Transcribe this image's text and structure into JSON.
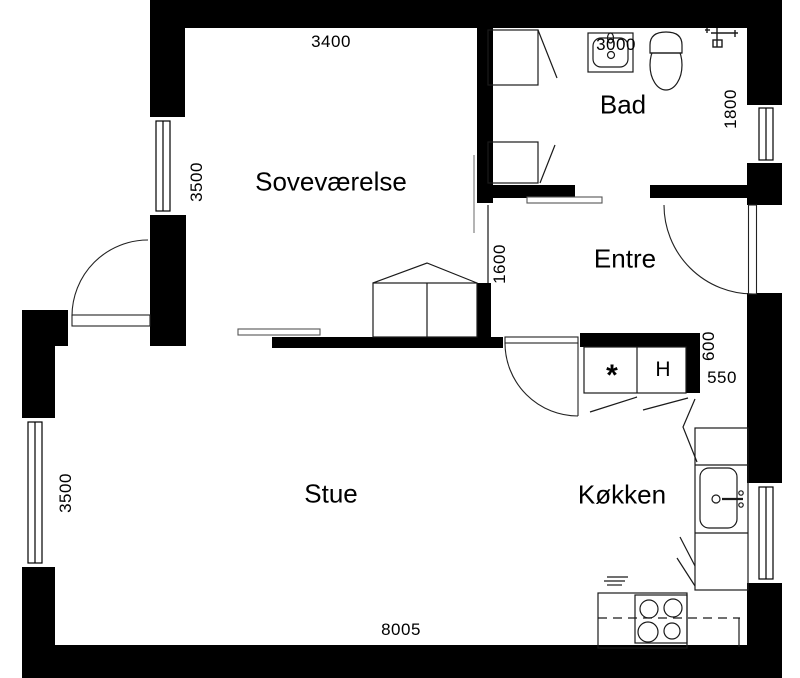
{
  "figure": "apartment-floor-plan",
  "rooms": {
    "sovevaerelse": "Soveværelse",
    "bad": "Bad",
    "entre": "Entre",
    "stue": "Stue",
    "koekken": "Køkken"
  },
  "dimensions": {
    "sovevaerelse_width": "3400",
    "bad_width": "3000",
    "bad_depth": "1800",
    "sovevaerelse_depth": "3500",
    "opening_width": "1600",
    "kitchen_nook_height": "600",
    "kitchen_nook_width": "550",
    "stue_depth": "3500",
    "total_width": "8005"
  },
  "markers": {
    "appliance_star": "*",
    "hood": "H"
  },
  "colors": {
    "wall": "#000000",
    "line": "#1a1a1a",
    "background": "#ffffff"
  }
}
